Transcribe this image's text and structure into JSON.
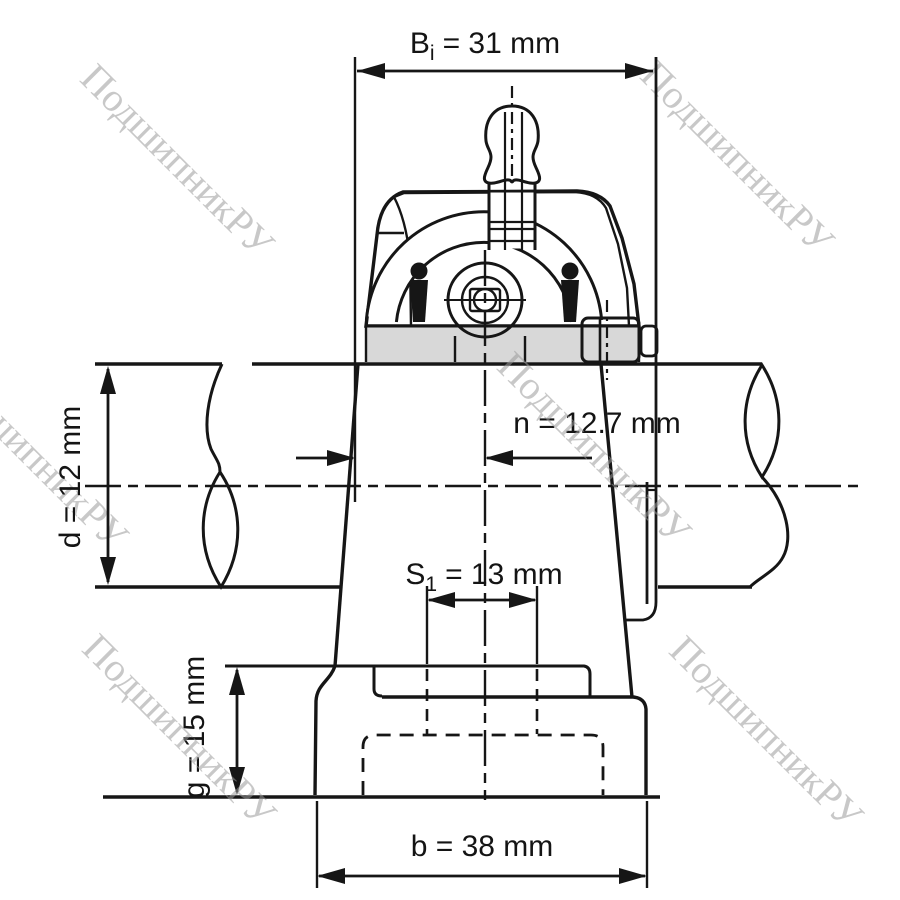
{
  "watermark": {
    "text": "ПодшипникРУ",
    "color": "#9a9a9a"
  },
  "colors": {
    "line": "#161616",
    "metal": "#d8d8d8",
    "background": "#ffffff"
  },
  "dimensions": {
    "Bi": {
      "sym": "B",
      "sub": "i",
      "rest": "= 31 mm"
    },
    "S1": {
      "sym": "S",
      "sub": "1",
      "rest": "= 13 mm"
    },
    "n": {
      "label": "n = 12.7 mm"
    },
    "d": {
      "label": "d = 12 mm"
    },
    "g": {
      "label": "g = 15 mm"
    },
    "b": {
      "label": "b = 38 mm"
    }
  }
}
